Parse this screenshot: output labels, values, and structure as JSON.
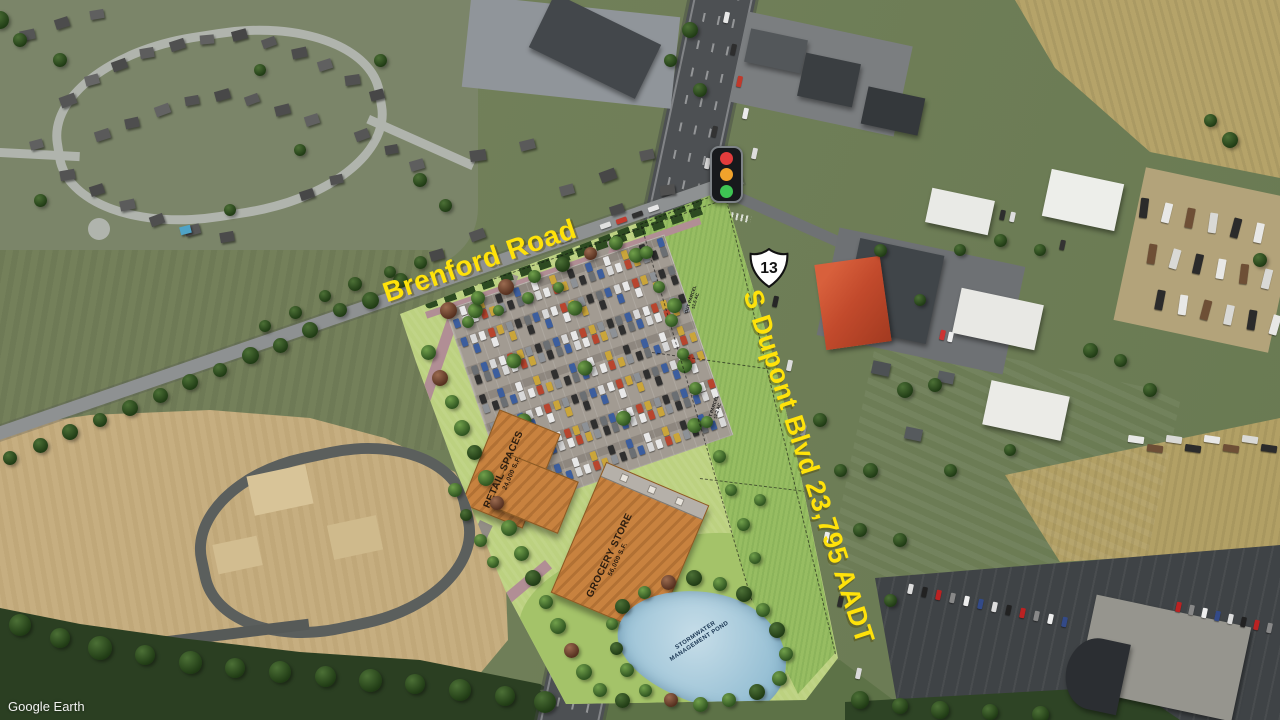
{
  "watermark": {
    "text": "Google Earth"
  },
  "labels": {
    "brenford": {
      "text": "Brenford Road"
    },
    "dupont": {
      "text": "S Dupont Blvd 23,795 AADT"
    }
  },
  "route_shield": {
    "number": "13"
  },
  "traffic_light": {
    "red": "#e23c3c",
    "amber": "#f0a32c",
    "green": "#3ec553"
  },
  "site_plan": {
    "retail": {
      "name": "RETAIL SPACES",
      "size": "24,000 S.F."
    },
    "grocery": {
      "name": "GROCERY STORE",
      "size": "56,000 S.F."
    },
    "pond": {
      "line1": "STORMWATER",
      "line2": "MANAGEMENT POND"
    },
    "outparcels": [
      {
        "line1": "OUT PARCEL",
        "line2": "±1.5 AC"
      },
      {
        "line1": "OUT PARCEL",
        "line2": "±1.2 AC"
      }
    ]
  },
  "colors": {
    "label_yellow": "#ffe20a",
    "roof_orange": "#c8823f",
    "pond_blue": "#a9cbdd",
    "site_green": "#bcd180",
    "highway_gray": "#4d5053"
  }
}
